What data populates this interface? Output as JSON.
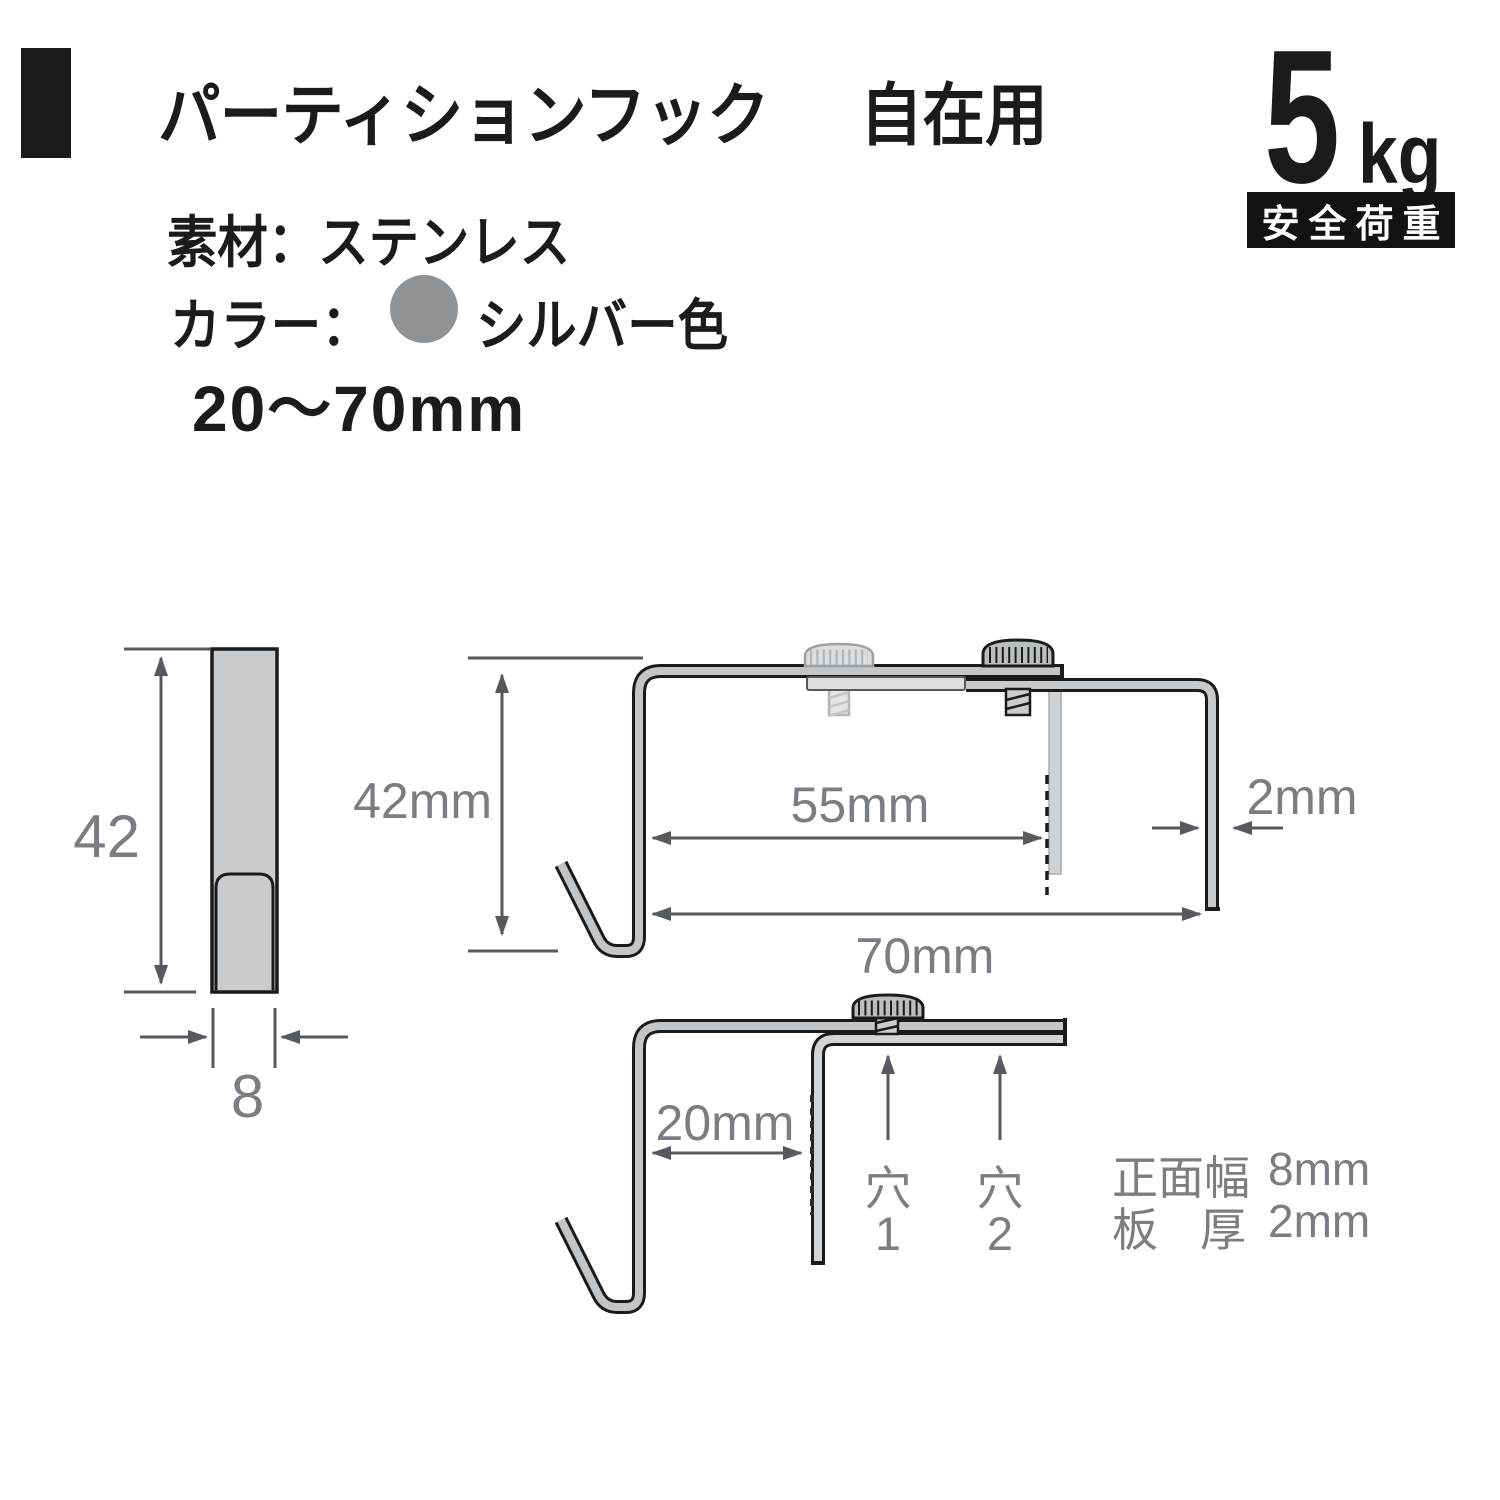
{
  "product": {
    "title_main": "パーティションフック",
    "title_sub": "自在用",
    "material": "素材：ステンレス",
    "color_label": "カラー：",
    "color_name": "シルバー色",
    "color_swatch_hex": "#8f9396",
    "size_range": "20〜70mm",
    "load_number": "5",
    "load_unit": "kg",
    "load_badge": "安全荷重"
  },
  "front_view": {
    "height": "42",
    "width": "8"
  },
  "side_view_max": {
    "height": "42mm",
    "screw_span": "55mm",
    "total_span": "70mm",
    "plate_thickness": "2mm"
  },
  "side_view_min": {
    "span": "20mm",
    "hole1_label": "穴",
    "hole1_num": "1",
    "hole2_label": "穴",
    "hole2_num": "2"
  },
  "specs": {
    "front_width_label": "正面幅",
    "front_width_value": "8mm",
    "thickness_label_left": "板",
    "thickness_label_right": "厚",
    "thickness_value": "2mm"
  },
  "colors": {
    "ink": "#1b1b1b",
    "arrow_gray": "#565a5e",
    "label_gray": "#7a7e82",
    "steel_gray": "#c2c6c9",
    "steel_light": "#dcdfe1"
  }
}
